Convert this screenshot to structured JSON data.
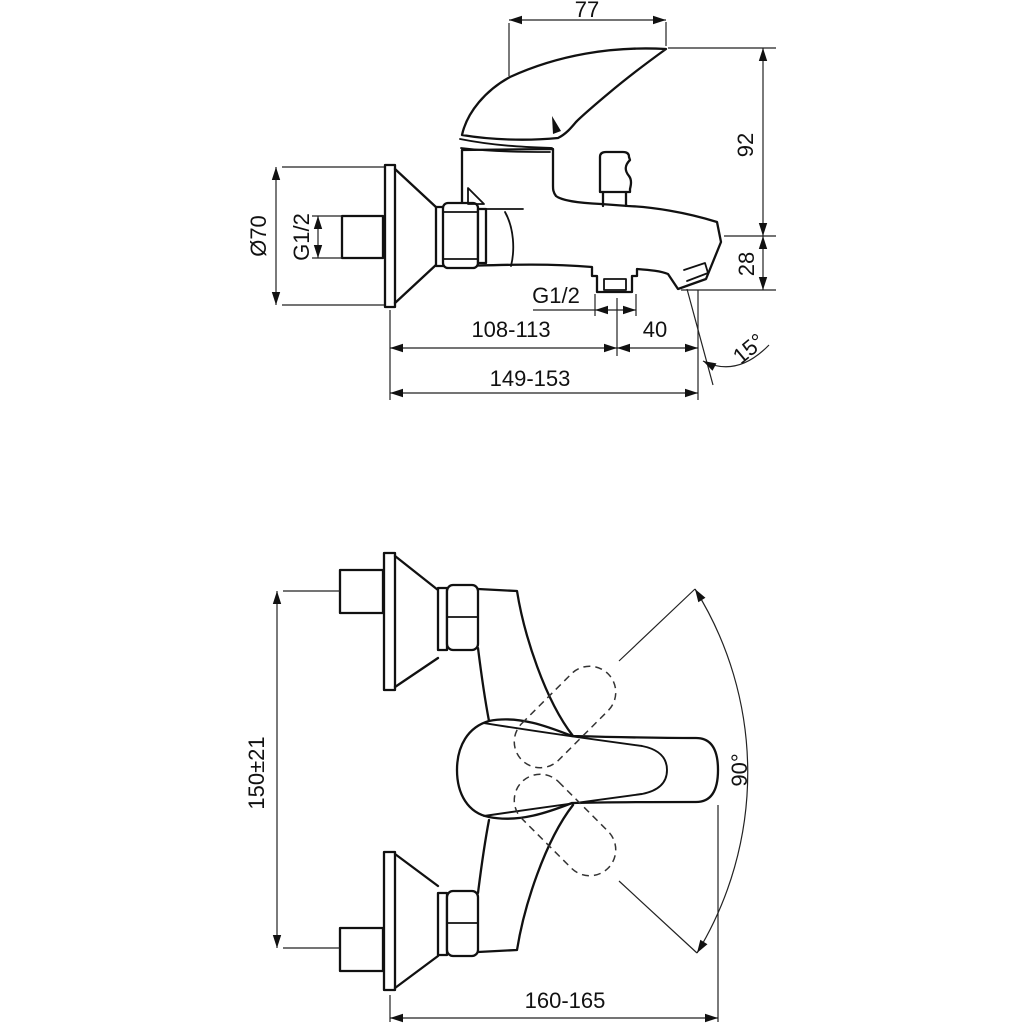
{
  "title": "Bath shower mixer tap - dimensional technical drawing",
  "colors": {
    "line": "#111111",
    "thin_line": "#222222",
    "background": "#ffffff"
  },
  "views": {
    "side": {
      "name": "side elevation view",
      "dims": {
        "handle_width": "77",
        "height_above": "92",
        "spout_drop": "28",
        "flange_diameter": "Ø70",
        "inlet_thread": "G1/2",
        "outlet_thread": "G1/2",
        "wall_to_outlet": "108-113",
        "outlet_to_spout": "40",
        "wall_to_spout": "149-153",
        "spout_angle": "15°"
      }
    },
    "plan": {
      "name": "plan view",
      "dims": {
        "inlet_spacing": "150±21",
        "handle_swing": "90°",
        "total_depth": "160-165"
      }
    }
  }
}
